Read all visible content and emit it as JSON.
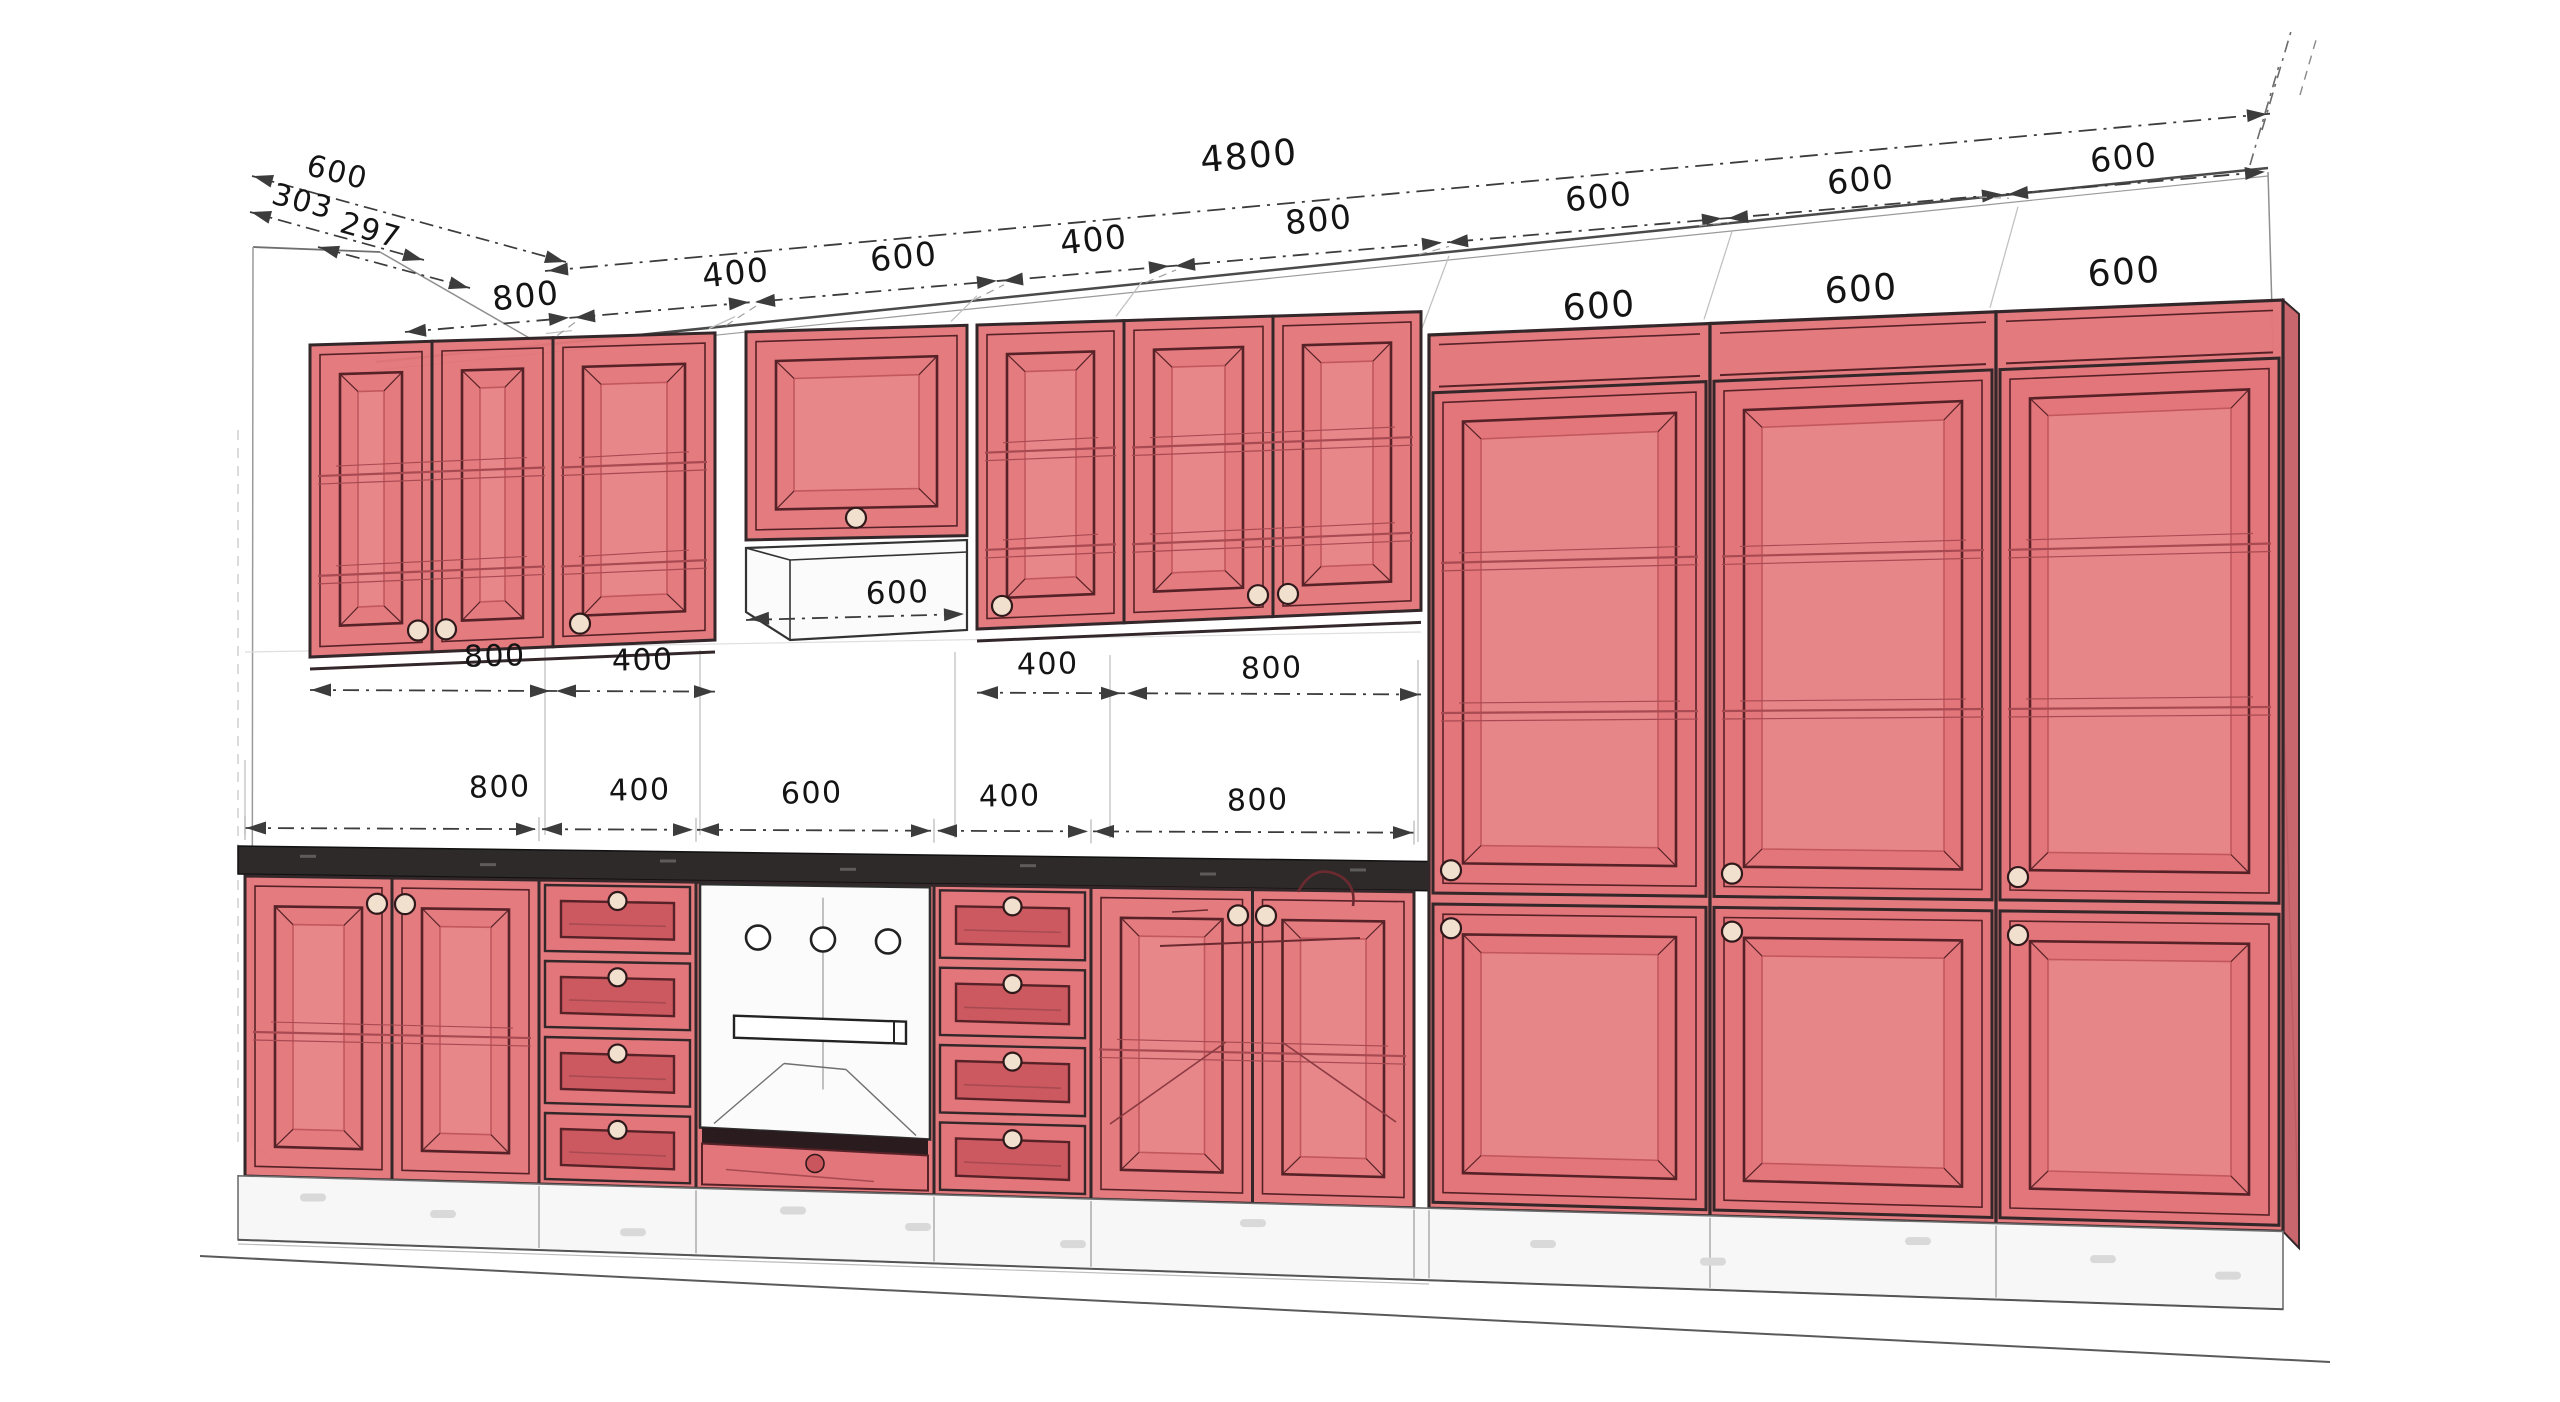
{
  "drawing": {
    "overall_width": "4800",
    "depth_dims": [
      "600",
      "303",
      "297"
    ],
    "top_segments": [
      "800",
      "400",
      "600",
      "400",
      "800",
      "600",
      "600",
      "600"
    ],
    "tall_top_labels": [
      "600",
      "600",
      "600"
    ],
    "hood_width": "600",
    "mid_segments": [
      "800",
      "400",
      "400",
      "800"
    ],
    "base_segments": [
      "800",
      "400",
      "600",
      "400",
      "800"
    ],
    "colors": {
      "cabinet": "#e2767a",
      "cabinet_panel": "#e88a8c",
      "cabinet_deep": "#c2585e",
      "drawer_inner": "#c9565c",
      "outline": "#33272a",
      "door_line": "#572227",
      "shelf_line": "#a84a52",
      "dim_line": "#3c3c3c",
      "dim_text": "#141414",
      "faint": "#c6c6c6",
      "counter": "#2e2a29",
      "knob": "#f2e0cf",
      "white_box": "#fbfbfb",
      "dark_band": "#2a1c1e"
    }
  }
}
